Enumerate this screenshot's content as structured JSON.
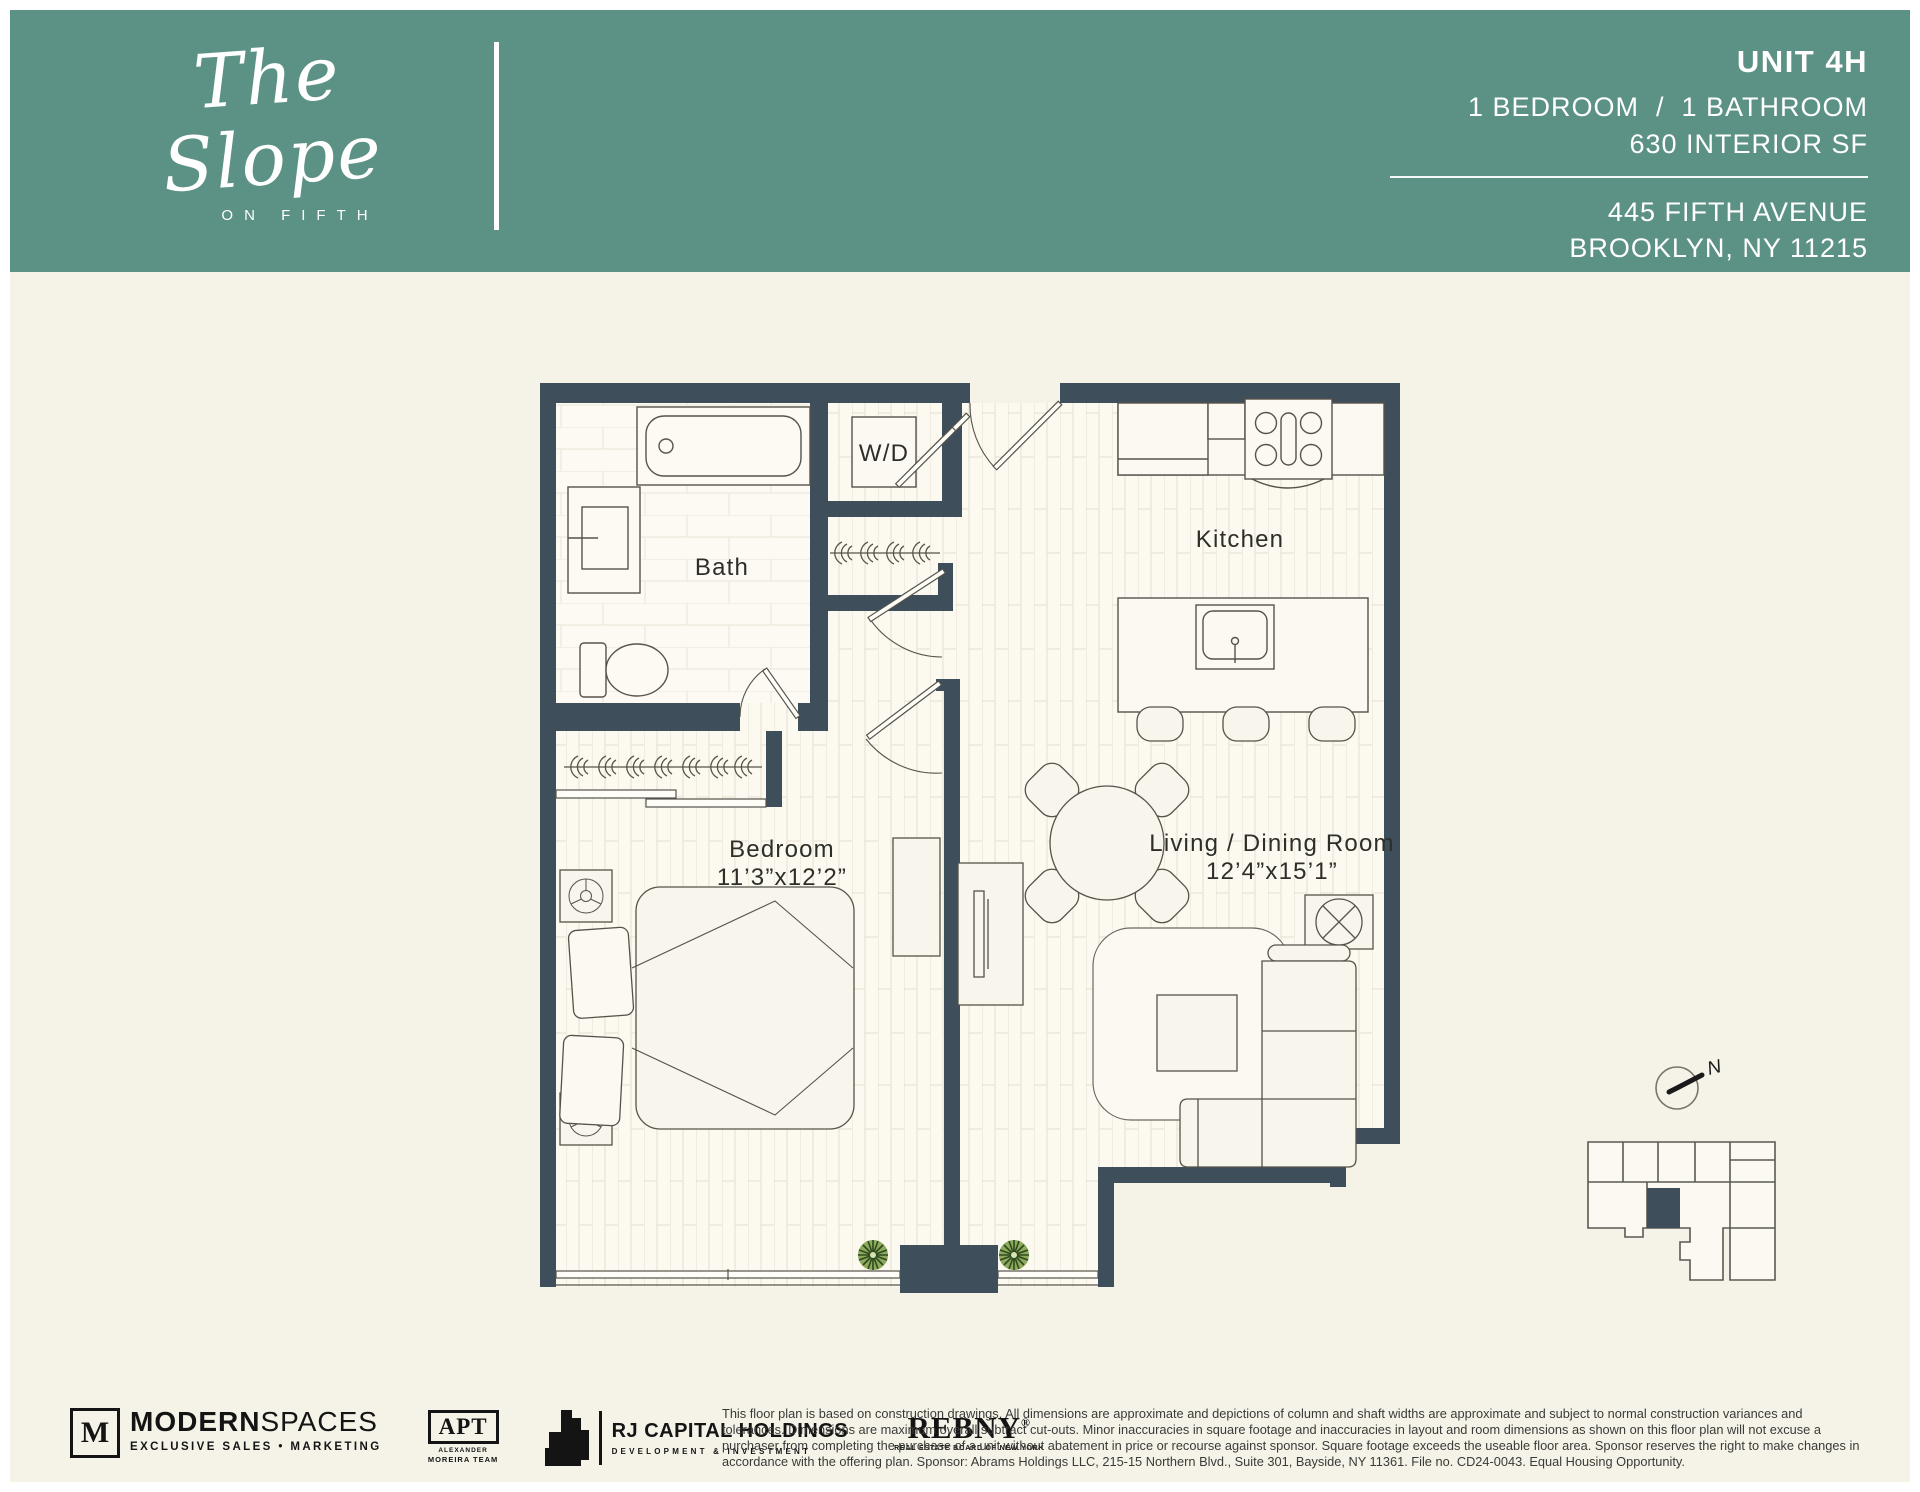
{
  "header": {
    "bg_color": "#5C9285",
    "brand_script": "The Slope",
    "brand_sub": "ON FIFTH",
    "unit": "UNIT 4H",
    "specs": "1 BEDROOM  /  1 BATHROOM",
    "interior_sf": "630 INTERIOR SF",
    "address1": "445 FIFTH AVENUE",
    "address2": "BROOKLYN, NY 11215"
  },
  "floorplan": {
    "wall_color": "#3E4E5A",
    "floor_color": "#FAF8EF",
    "labels": {
      "bath": "Bath",
      "wd": "W/D",
      "kitchen": "Kitchen",
      "bedroom": "Bedroom",
      "bedroom_dims": "11’3”x12’2”",
      "living": "Living / Dining Room",
      "living_dims": "12’4”x15’1”",
      "compass": "N"
    }
  },
  "footer": {
    "logos": {
      "modernspaces": {
        "mark": "M",
        "name_bold": "MODERN",
        "name_light": "SPACES",
        "tagline": "EXCLUSIVE SALES • MARKETING"
      },
      "apt": {
        "mark": "APT",
        "line1": "ALEXANDER",
        "line2": "MOREIRA TEAM"
      },
      "rj": {
        "name": "RJ CAPITAL HOLDINGS",
        "tagline": "DEVELOPMENT & INVESTMENT"
      },
      "rebny": {
        "name": "REBNY",
        "mark": "®",
        "tagline": "REAL ESTATE BOARD OF NEW YORK"
      }
    },
    "disclaimer": "This floor plan is based on construction drawings. All dimensions are approximate and depictions of column and shaft widths are approximate and subject to normal construction variances and tolerances. Dimensions are maximum overall subtract cut-outs. Minor inaccuracies in square footage and inaccuracies in layout and room dimensions as shown on this floor plan will not excuse a purchaser from completing the purchase of a unit without abatement in price or recourse against sponsor. Square footage exceeds the useable floor area. Sponsor reserves the right to make changes in accordance with the offering plan. Sponsor: Abrams Holdings LLC, 215-15 Northern Blvd., Suite 301, Bayside, NY 11361. File no. CD24-0043. Equal Housing Opportunity."
  }
}
